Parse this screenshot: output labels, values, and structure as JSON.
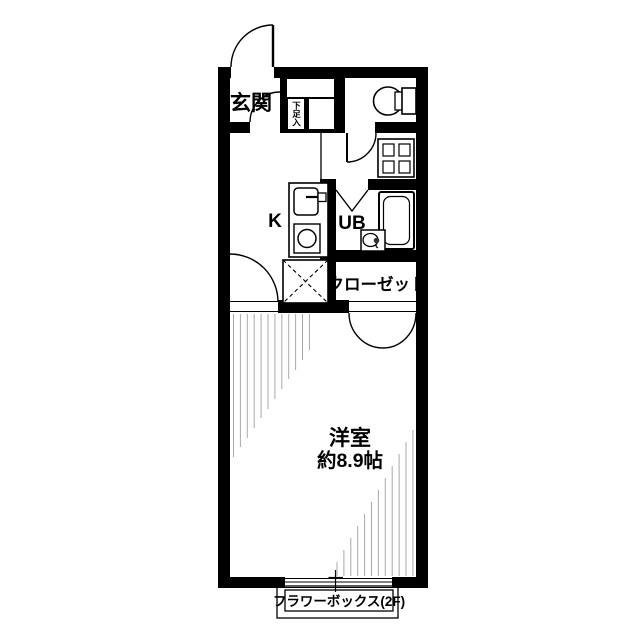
{
  "plan": {
    "title": "1K apartment floor plan",
    "labels": {
      "entrance": "玄関",
      "shoe_storage": "下足入",
      "kitchen": "K",
      "unit_bath": "UB",
      "closet": "クローゼット",
      "room_name": "洋室",
      "room_size": "約8.9帖",
      "flower_box": "フラワーボックス(2F)"
    },
    "colors": {
      "wall": "#000000",
      "line": "#000000",
      "hatch": "#a8a8a8",
      "background": "#ffffff"
    }
  }
}
